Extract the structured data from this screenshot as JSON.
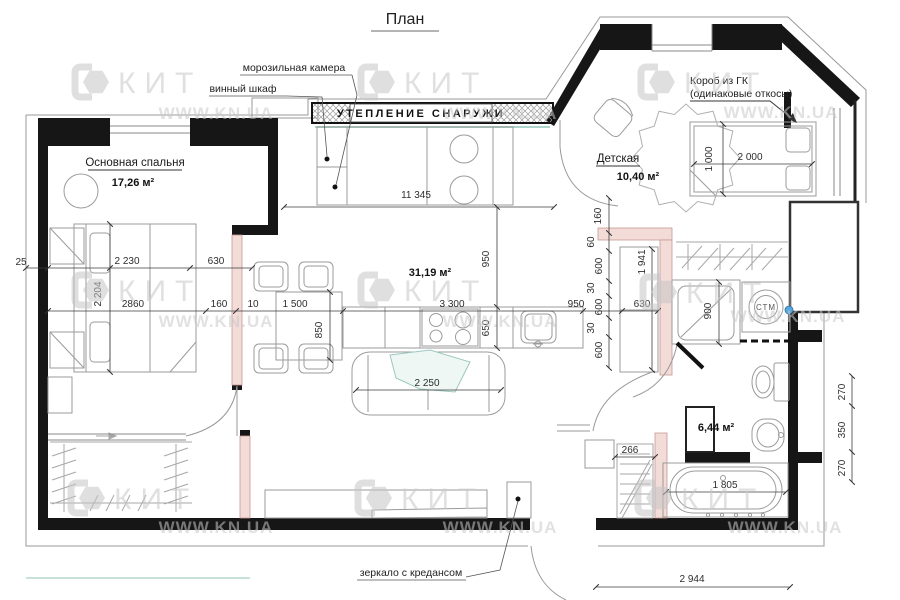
{
  "title": "План",
  "watermark": {
    "brand": "КИТ",
    "site": "WWW.KN.UA"
  },
  "rooms": {
    "bedroom": {
      "name": "Основная спальня",
      "area": "17,26 м²"
    },
    "kids": {
      "name": "Детская",
      "area": "10,40 м²"
    },
    "living": {
      "area": "31,19 м²"
    },
    "bathroom": {
      "area": "6,44 м²"
    }
  },
  "callouts": {
    "freezer": "морозильная камера",
    "wine_cabinet": "винный шкаф",
    "insulation": "УТЕПЛЕНИЕ СНАРУЖИ",
    "gk_box_line1": "Короб из ГК",
    "gk_box_line2": "(одинаковые откосы)",
    "mirror": "зеркало с кредансом",
    "washer": "СТМ"
  },
  "dims": {
    "top_total": "11 345",
    "left_gap": "25",
    "bed_width": "2 230",
    "bed_side": "630",
    "bed_length": "2 204",
    "bedroom_width": "2860",
    "seg_160": "160",
    "seg_10": "10",
    "dining_len": "1 500",
    "dining_dep": "850",
    "kitchen_len": "3 300",
    "kitchen_dep": "650",
    "pass_v": "950",
    "pass_h": "950",
    "hall_cab": "630",
    "shower": "900",
    "chain_160": "160",
    "chain_60": "60",
    "chain_600a": "600",
    "chain_30a": "30",
    "chain_600b": "600",
    "chain_30b": "30",
    "chain_600c": "600",
    "hall_len": "1 941",
    "kid_bed_len": "2 000",
    "kid_bed_w": "1 000",
    "bath_shelf": "266",
    "tub_len": "1 805",
    "bottom_total": "2 944",
    "right_270a": "270",
    "right_350": "350",
    "right_270b": "270",
    "sofa_len": "2 250"
  },
  "colors": {
    "wall_highlight": "#f3dbd8",
    "glazing": "#aed6cc",
    "marker_blue": "#57a7dc"
  }
}
